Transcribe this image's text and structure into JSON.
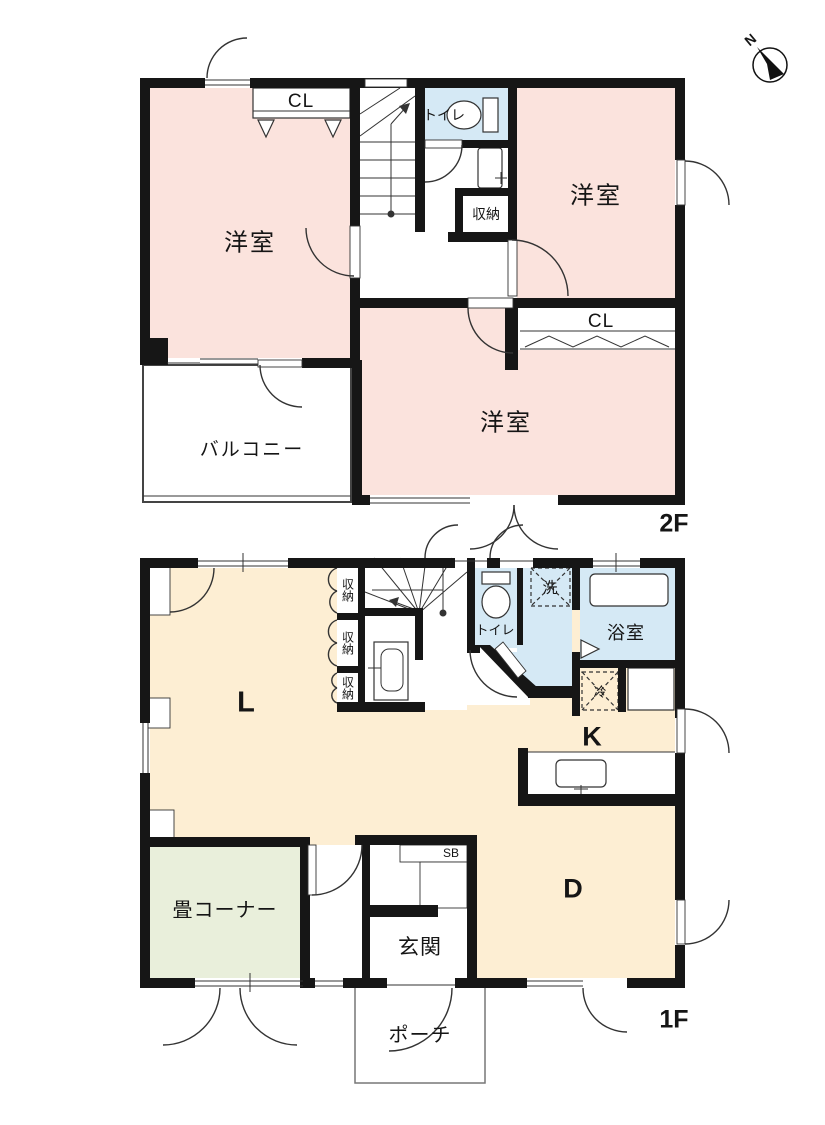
{
  "compass": {
    "north_label": "N"
  },
  "floor2": {
    "floor_label": "2F",
    "room_nw_label": "洋室",
    "room_ne_label": "洋室",
    "room_s_label": "洋室",
    "closet_nw_label": "CL",
    "closet_s_label": "CL",
    "toilet_label": "トイレ",
    "storage_label": "収納",
    "balcony_label": "バルコニー"
  },
  "floor1": {
    "floor_label": "1F",
    "living_label": "L",
    "kitchen_label": "K",
    "dining_label": "D",
    "tatami_label": "畳コーナー",
    "entrance_label": "玄関",
    "porch_label": "ポーチ",
    "shoe_box_label": "SB",
    "toilet_label": "トイレ",
    "laundry_label": "洗",
    "bath_label": "浴室",
    "fridge_label": "冷",
    "storage1_label": "収納",
    "storage2_label": "収納",
    "storage3_label": "収納"
  },
  "colors": {
    "bedroom_pink": "#fbe3dd",
    "wet_area_blue": "#d5e9f5",
    "ldk_beige": "#fdeed3",
    "tatami_green": "#e9efdb",
    "wall_black": "#161616"
  }
}
